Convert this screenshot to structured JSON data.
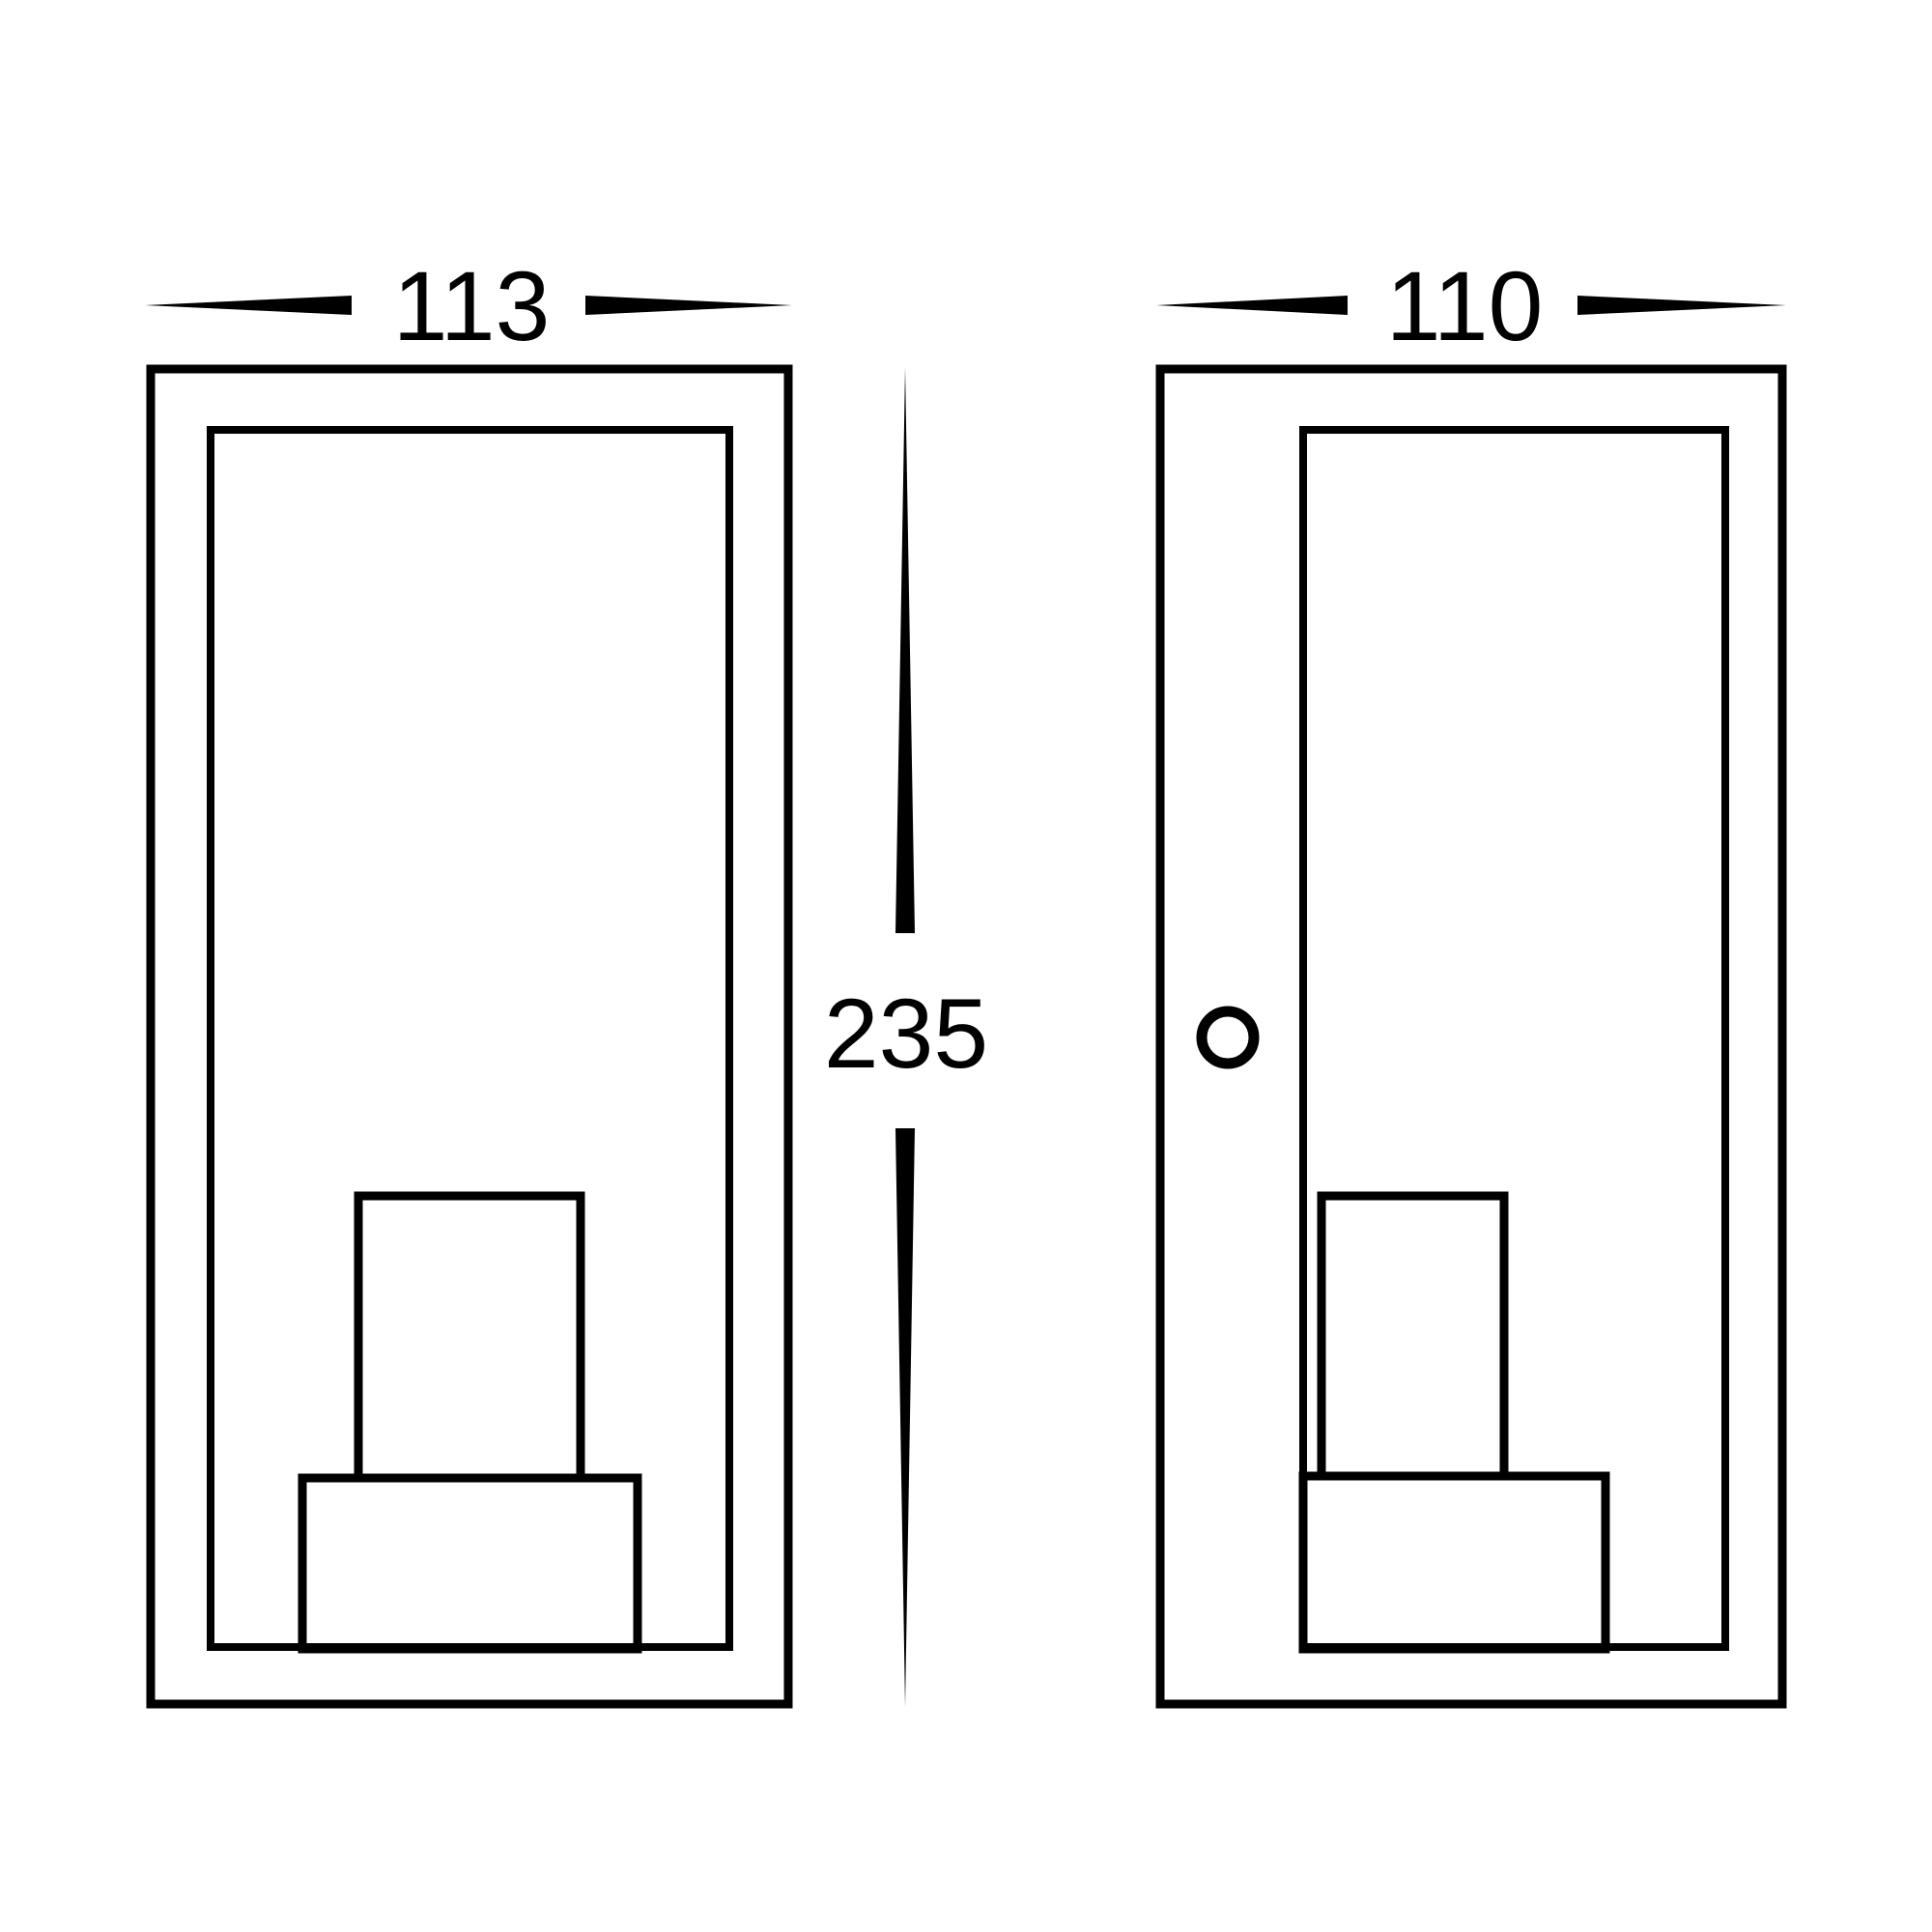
{
  "drawing": {
    "description": "Two-view technical dimension drawing of a rectangular box wall light",
    "background_color": "#ffffff",
    "line_color": "#000000",
    "front_view": {
      "width_label": "113"
    },
    "side_view": {
      "depth_label": "110"
    },
    "height_label": "235"
  }
}
